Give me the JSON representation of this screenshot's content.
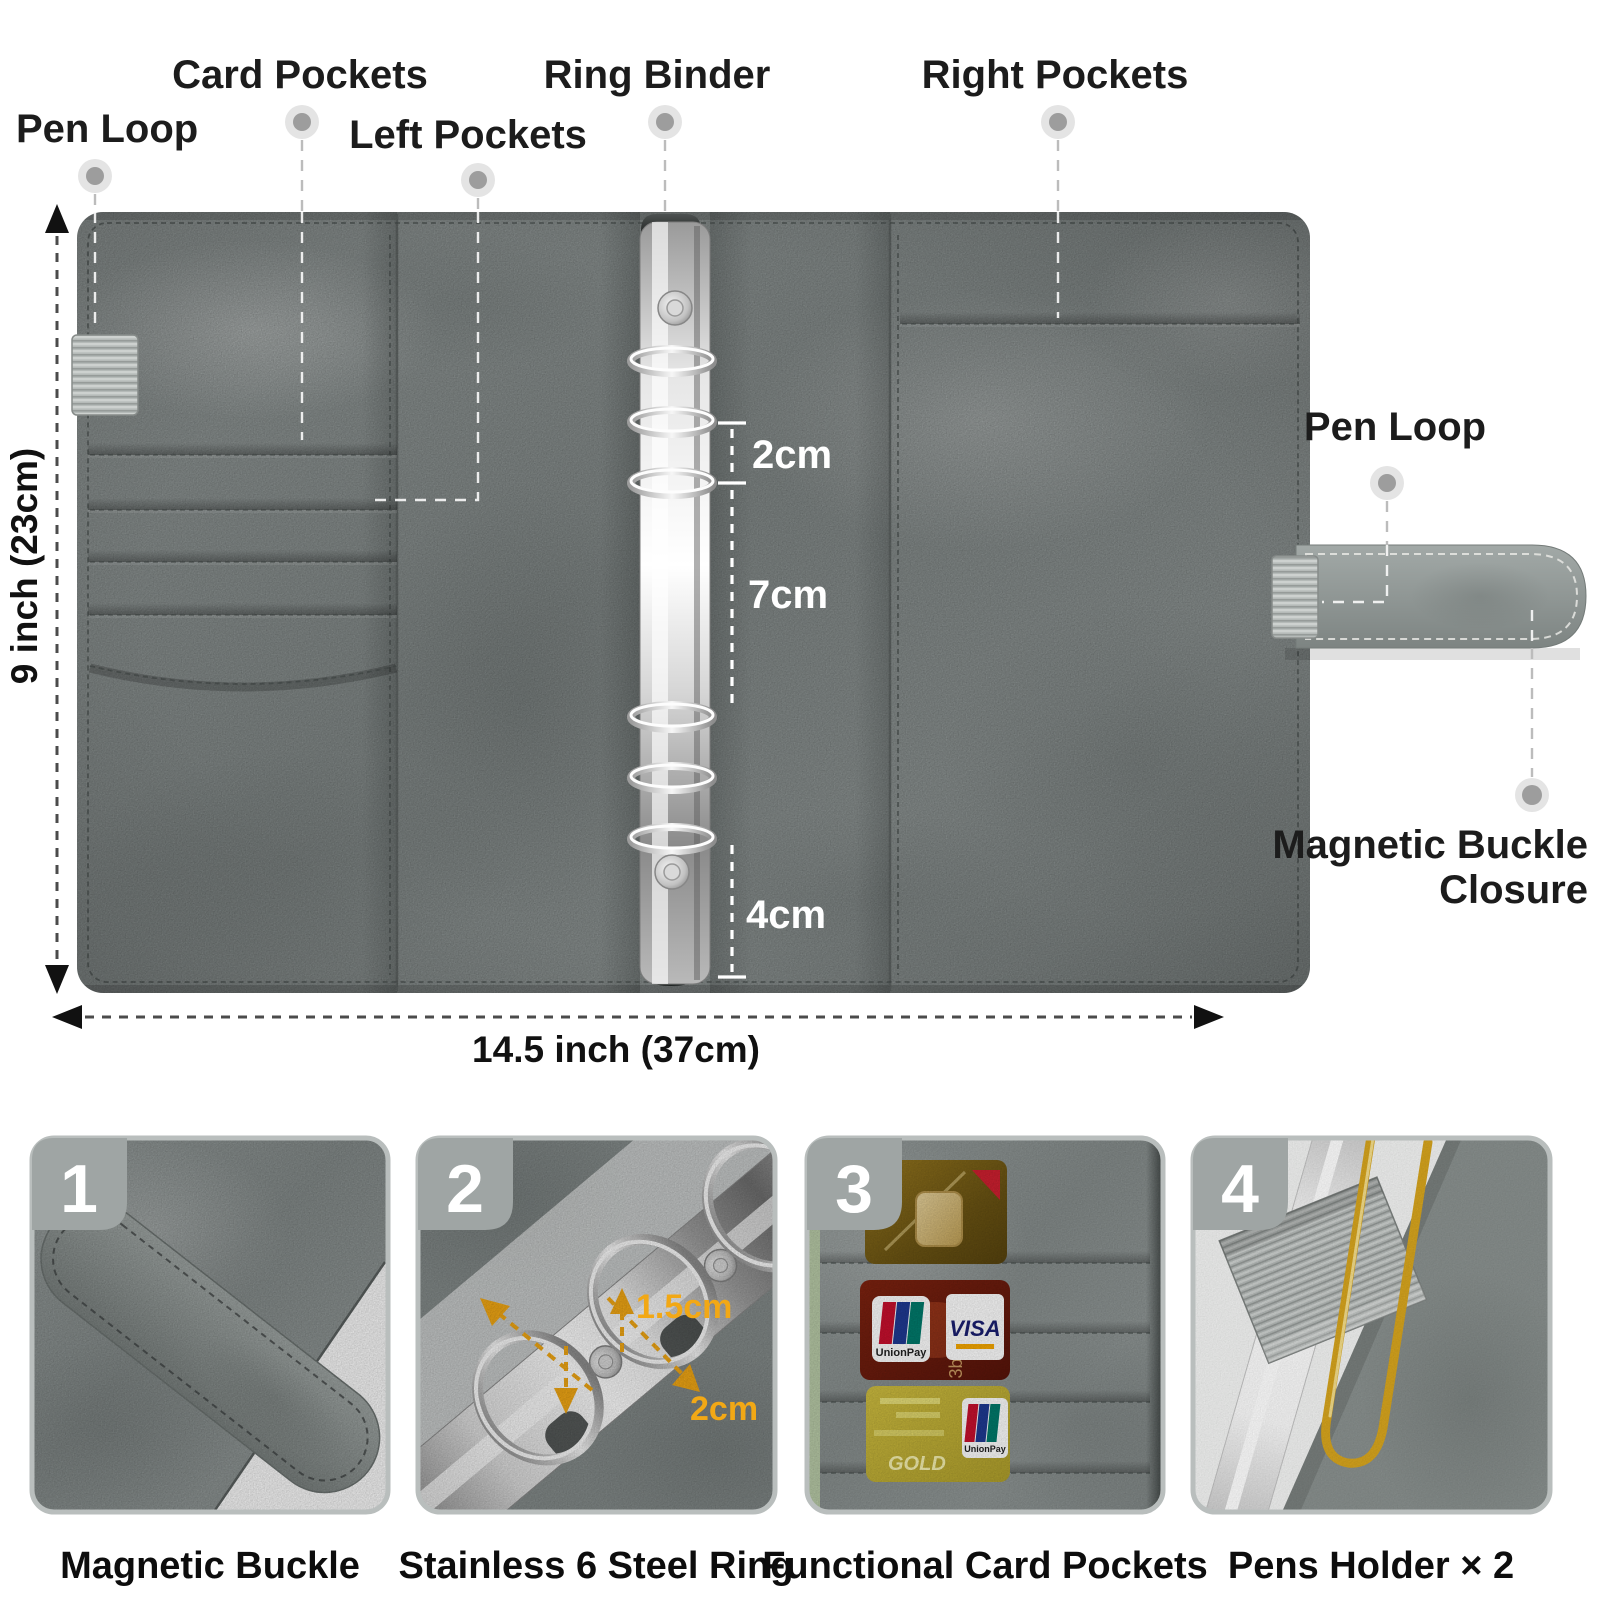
{
  "annotations": {
    "pen_loop_left": "Pen Loop",
    "card_pockets": "Card Pockets",
    "left_pockets": "Left Pockets",
    "ring_binder": "Ring Binder",
    "right_pockets": "Right Pockets",
    "pen_loop_right": "Pen Loop",
    "magnetic_buckle_closure_line1": "Magnetic Buckle",
    "magnetic_buckle_closure_line2": "Closure"
  },
  "dimensions": {
    "height_label": "9 inch (23cm)",
    "width_label": "14.5 inch (37cm)"
  },
  "ring_measures": {
    "gap_top": "2cm",
    "gap_mid": "7cm",
    "gap_bottom": "4cm"
  },
  "features": [
    {
      "number": "1",
      "caption": "Magnetic Buckle"
    },
    {
      "number": "2",
      "caption": "Stainless 6 Steel Ring",
      "measure_small": "1.5cm",
      "measure_large": "2cm"
    },
    {
      "number": "3",
      "caption": "Functional Card Pockets"
    },
    {
      "number": "4",
      "caption": "Pens Holder × 2"
    }
  ],
  "cards": {
    "visa": "VISA",
    "unionpay": "UnionPay",
    "gold": "GOLD",
    "embossed": "3b 7b"
  },
  "colors": {
    "leather": "#8b9291",
    "leather_dark": "#6f7675",
    "elastic": "#b7bcba",
    "metal_bright": "#ffffff",
    "metal_mid": "#b5b5b5",
    "accent_yellow": "#f2a815",
    "visa_blue": "#1a1f71",
    "card_red": "#6d1b0c",
    "card_gold_dark": "#6b5413",
    "card_gold_light": "#c5b53c",
    "badge_gray": "#9fa5a4",
    "text_dark": "#1c1c1c"
  }
}
